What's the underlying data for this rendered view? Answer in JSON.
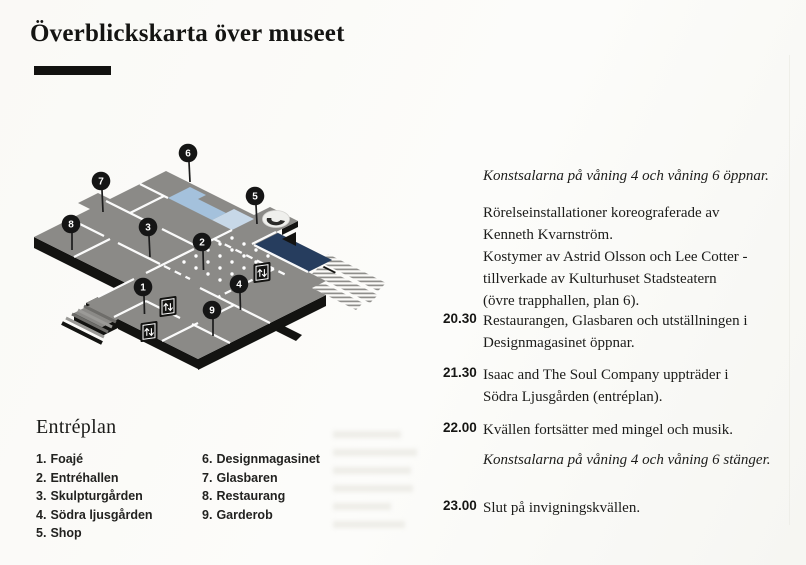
{
  "page": {
    "title": "Överblickskarta över museet"
  },
  "legend": {
    "heading": "Entréplan",
    "items": [
      {
        "num": "1.",
        "label": "Foajé"
      },
      {
        "num": "2.",
        "label": "Entréhallen"
      },
      {
        "num": "3.",
        "label": "Skulpturgården"
      },
      {
        "num": "4.",
        "label": "Södra ljusgården"
      },
      {
        "num": "5.",
        "label": "Shop"
      },
      {
        "num": "6.",
        "label": "Designmagasinet"
      },
      {
        "num": "7.",
        "label": "Glasbaren"
      },
      {
        "num": "8.",
        "label": "Restaurang"
      },
      {
        "num": "9.",
        "label": "Garderob"
      }
    ]
  },
  "map": {
    "pins": [
      {
        "number": "1"
      },
      {
        "number": "2"
      },
      {
        "number": "3"
      },
      {
        "number": "4"
      },
      {
        "number": "5"
      },
      {
        "number": "6"
      },
      {
        "number": "7"
      },
      {
        "number": "8"
      },
      {
        "number": "9"
      }
    ],
    "colors": {
      "floor": "#8b8a87",
      "room_blue": "#a4c1dc",
      "room_blue_light": "#c7d8e8",
      "room_navy": "#263d5e",
      "base_black": "#131311",
      "wall_white": "#ffffff"
    }
  },
  "schedule": {
    "opening_note": "Konstsalarna på våning 4 och våning 6 öppnar.",
    "description_lines": [
      "Rörelseinstallationer koreograferade av",
      "Kenneth Kvarnström.",
      "Kostymer av Astrid Olsson och Lee Cotter -",
      "tillverkade av Kulturhuset Stadsteatern",
      "(övre trapphallen, plan 6)."
    ],
    "events": [
      {
        "time": "20.30",
        "line1": "Restaurangen, Glasbaren och utställningen i",
        "line2": "Designmagasinet öppnar."
      },
      {
        "time": "21.30",
        "line1": "Isaac and The Soul Company uppträder i",
        "line2": "Södra Ljusgården (entréplan)."
      },
      {
        "time": "22.00",
        "line1": "Kvällen fortsätter med mingel och musik.",
        "line2": ""
      },
      {
        "time": "23.00",
        "line1": "Slut på invigningskvällen.",
        "line2": ""
      }
    ],
    "closing_note": "Konstsalarna på våning 4 och våning 6 stänger."
  }
}
